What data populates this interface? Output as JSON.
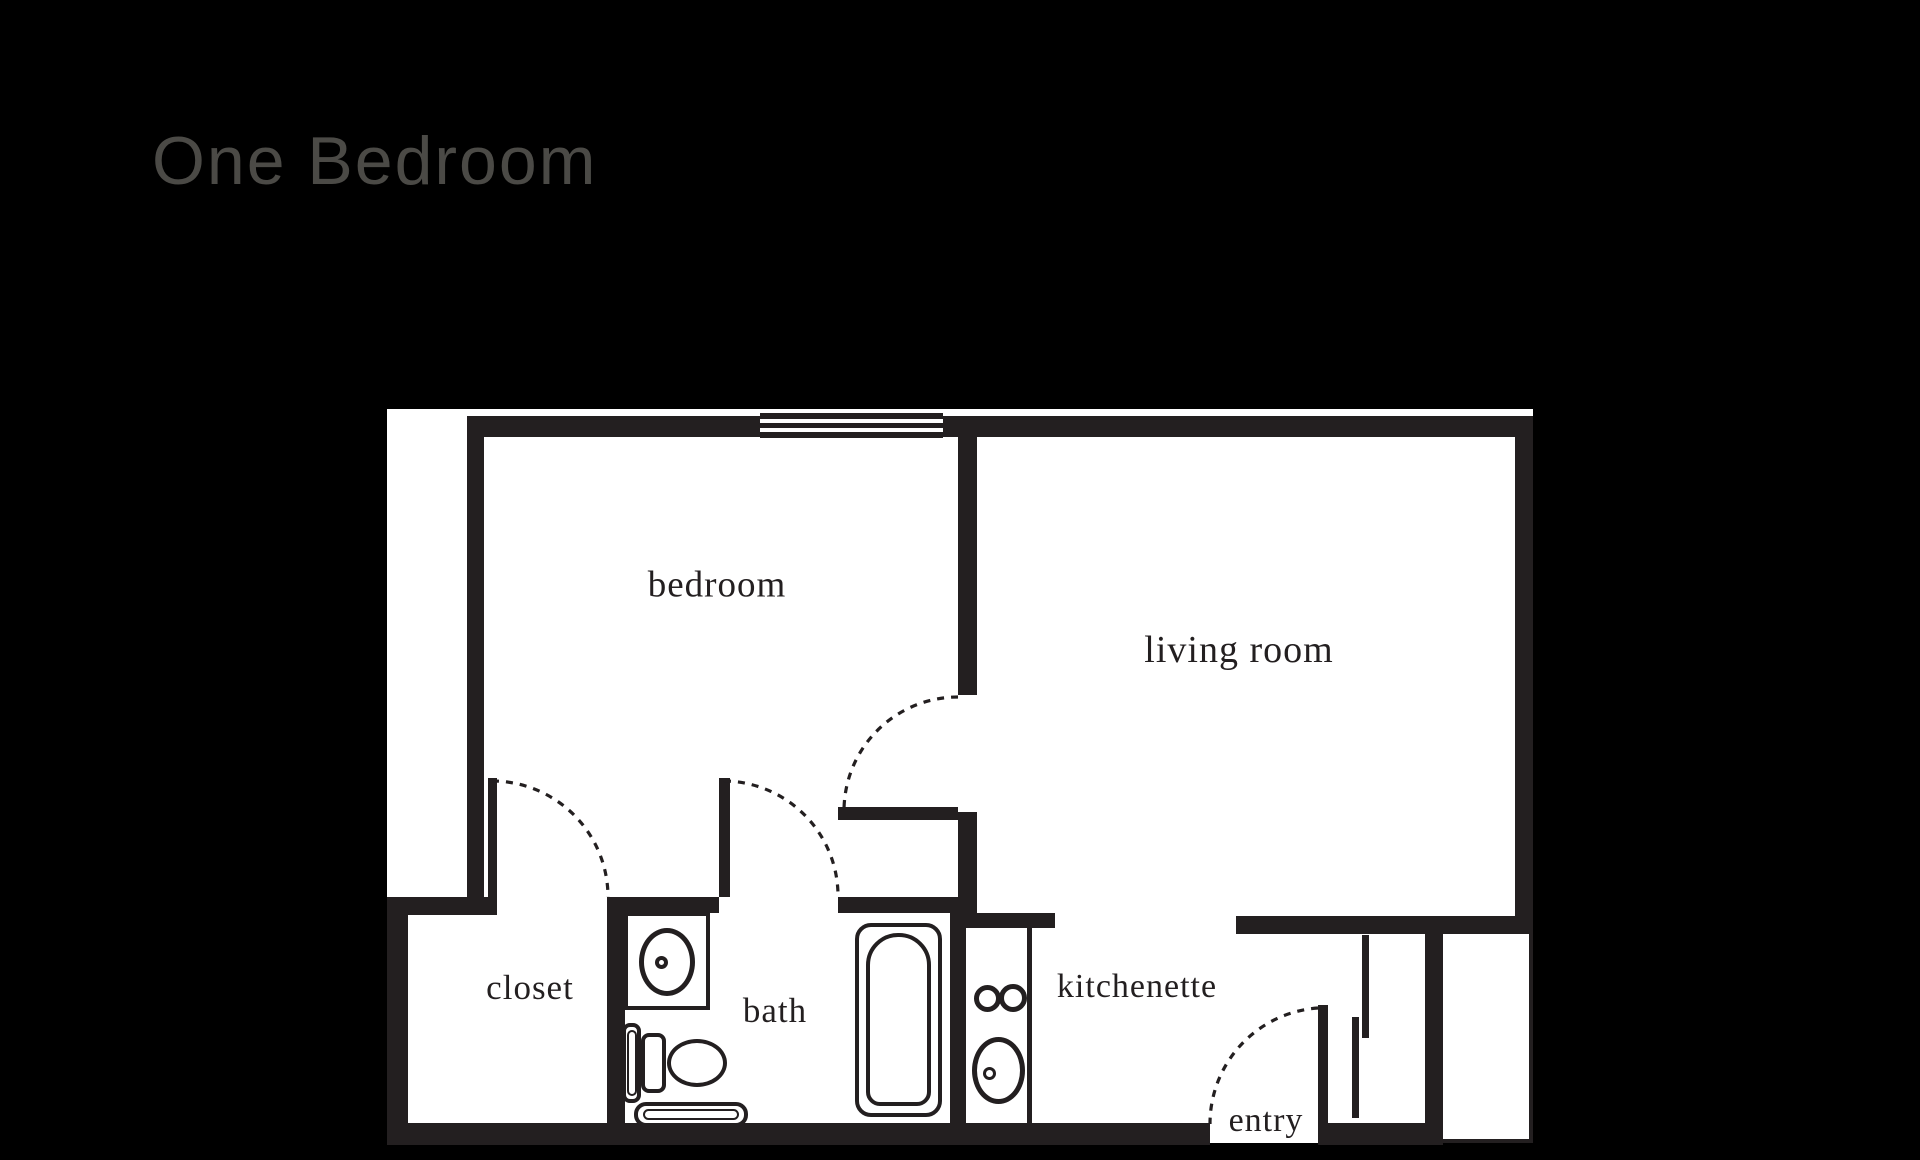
{
  "title": "One Bedroom",
  "colors": {
    "page_bg": "#000000",
    "plan_bg": "#ffffff",
    "wall": "#231f20",
    "title_text": "#4b4a46",
    "label_text": "#231f20"
  },
  "rooms": {
    "bedroom": "bedroom",
    "living_room": "living room",
    "closet": "closet",
    "bath": "bath",
    "kitchenette": "kitchenette",
    "entry": "entry"
  },
  "fixtures": {
    "window": "window",
    "bathtub": "bathtub",
    "toilet": "toilet",
    "vanity_sink": "vanity-sink",
    "bath_mat": "bath-mat",
    "stove_burners": "stove-burners",
    "kitchen_sink": "kitchen-sink",
    "entry_door": "entry-door",
    "closet_door": "closet-door",
    "bath_door": "bath-door",
    "hall_door": "hall-door",
    "sliding_closet_doors": "sliding-closet-doors"
  }
}
